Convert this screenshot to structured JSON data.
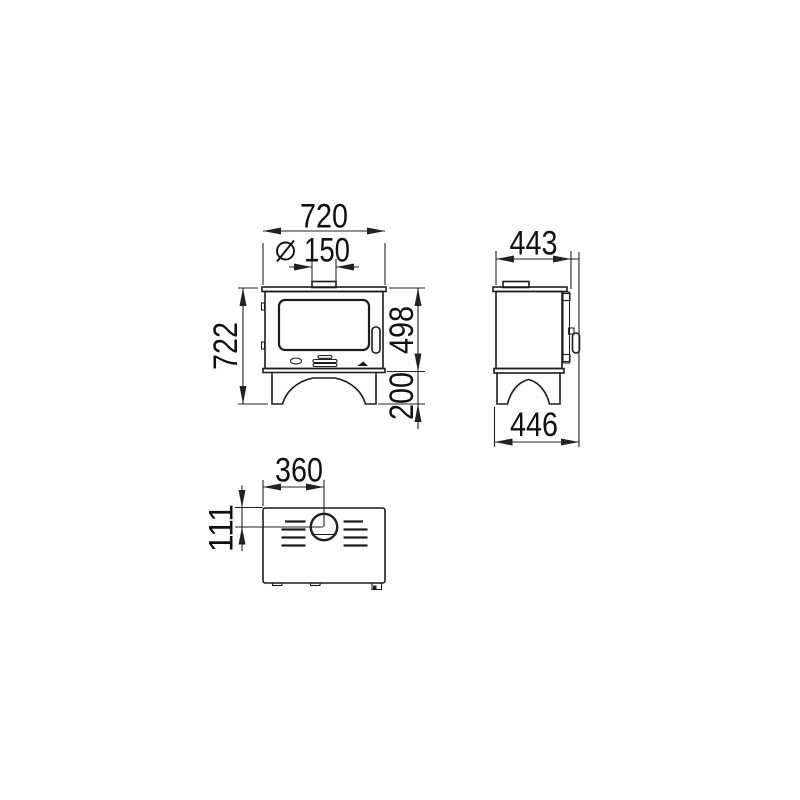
{
  "drawing": {
    "title": "stove-three-view-dimension-drawing",
    "style": {
      "background": "#ffffff",
      "line_color": "#1d1d1d",
      "dimension_color": "#222222",
      "text_color": "#111111"
    },
    "front_view": {
      "overall_width": "720",
      "flue_diameter": "150",
      "diameter_symbol": "⌀",
      "overall_height": "722",
      "body_height": "498",
      "leg_height": "200"
    },
    "side_view": {
      "overall_depth_top": "443",
      "overall_depth_bottom": "446"
    },
    "top_view": {
      "flue_center_from_side": "360",
      "flue_center_from_rear": "111"
    }
  }
}
